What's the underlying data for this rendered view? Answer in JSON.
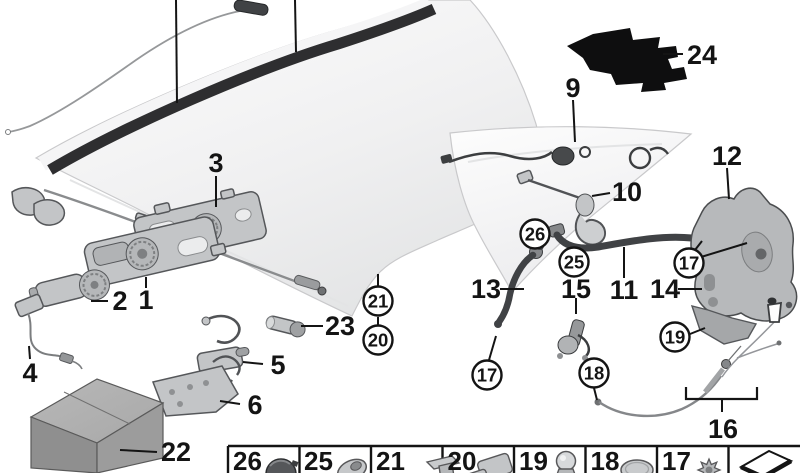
{
  "diagram": {
    "type": "exploded-parts-diagram",
    "subject": "convertible-hardtop-mounting-parts"
  },
  "colors": {
    "background": "#ffffff",
    "line": "#141414",
    "seal_strip": "#2e2e30",
    "tube": "#404245",
    "part_fill": "#c3c5c7",
    "part_stroke": "#55575a",
    "patch": "#0e0e0f",
    "roof_edge": "#c9c9cb"
  },
  "callouts": {
    "plain": [
      {
        "label": "3"
      },
      {
        "label": "1"
      },
      {
        "label": "2"
      },
      {
        "label": "4"
      },
      {
        "label": "5"
      },
      {
        "label": "6"
      },
      {
        "label": "22"
      },
      {
        "label": "23"
      },
      {
        "label": "9"
      },
      {
        "label": "10"
      },
      {
        "label": "24"
      },
      {
        "label": "12"
      },
      {
        "label": "13"
      },
      {
        "label": "15"
      },
      {
        "label": "11"
      },
      {
        "label": "14"
      },
      {
        "label": "16"
      }
    ],
    "circled": [
      {
        "label": "21"
      },
      {
        "label": "20"
      },
      {
        "label": "26"
      },
      {
        "label": "25"
      },
      {
        "label": "17"
      },
      {
        "label": "19"
      },
      {
        "label": "18"
      },
      {
        "label": "17"
      }
    ]
  },
  "legend": {
    "cells": [
      {
        "label": "26",
        "icon": "grommet-icon"
      },
      {
        "label": "25",
        "icon": "angled-washer-icon"
      },
      {
        "label": "21",
        "icon": "rivet-plug-icon"
      },
      {
        "label": "20",
        "icon": "adhesive-pad-icon"
      },
      {
        "label": "19",
        "icon": "ball-pin-icon"
      },
      {
        "label": "18",
        "icon": "cover-cap-icon"
      },
      {
        "label": "17",
        "icon": "expanding-nut-icon"
      },
      {
        "label": "",
        "icon": "direction-arrow-icon"
      }
    ]
  }
}
